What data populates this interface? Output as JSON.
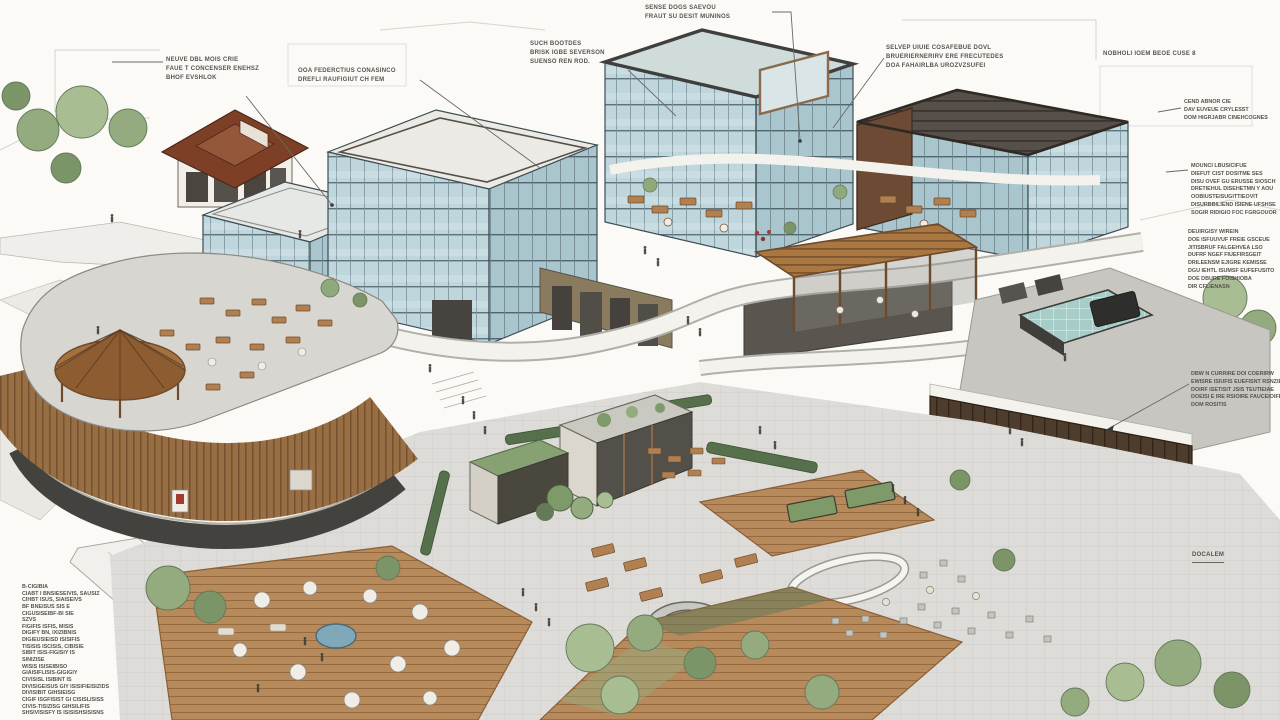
{
  "figure_title": "",
  "palette": {
    "background": "#fbfaf7",
    "glass_blue": "#bfd6dc",
    "glass_dark": "#a9c6ce",
    "mullion": "#5d727b",
    "wood_slat": "#a2764a",
    "wood_dark": "#7c5631",
    "pergola_wood": "#ab7741",
    "deck_wood": "#b78a5c",
    "paving_gray": "#dddcd8",
    "deck_gray": "#c7c6c1",
    "skylight_teal": "#a6cdc8",
    "dark_cladding": "#4e3c2c",
    "roof_red_brown": "#7d4026",
    "foliage": "#93ab7e",
    "foliage_dark": "#647a58",
    "slab_white": "#f4f2ec",
    "annotation_ink": "#55544f",
    "accent_red": "#a23c2e",
    "water_blue": "#7fa8b8"
  },
  "annotations": {
    "top_center": {
      "lines": [
        "SENSE DOGS SAEVOU",
        "FRAUT SU DESIT MUNINOS"
      ]
    },
    "top_left": {
      "lines": [
        "NEUVE DBL MOIS CRIE",
        "FAUE T CONCENSER ENEHSZ",
        "BHOF EVSHLOK"
      ]
    },
    "podium_note": {
      "lines": [
        "OOA FEDERCTIUS CONASINCO",
        "DREFLI RAUFIGIUT CH FEM"
      ]
    },
    "tower_mid": {
      "lines": [
        "SUCH BOOTDES",
        "BRISK IGBE SEVERSON",
        "SUENSO REN ROD."
      ]
    },
    "tower_right": {
      "lines": [
        "SELVEP UIUIE COSAFEBUE DOVL",
        "BRUERIERNERIRV ERE FRECUTEDES",
        "DOA FAHAIRLBA UROZVZSUFEI"
      ]
    },
    "site_right": {
      "lines": [
        "NOBHOLI IOEM BEOE CUSE 8"
      ]
    },
    "right_block_a": {
      "lines": [
        "CEND ABNOR CIE",
        "DAV EUVEUE CRYLESST",
        "DOM HIGRJABR CINEHCOGNES"
      ]
    },
    "right_block_b": {
      "lines": [
        "MOUNCI LBUSICIFUE",
        "DIEFUT CIST DOSITME SES",
        "DISU OVEF GU ERUSSE SIOSCH",
        "DRETIEHUL DISEHETMN Y AOU",
        "OOBIUSTEISUGITTIEOVIT",
        "DISURBBILIEND ISIENE UFSHSE",
        "SOGIR RIDIGIO FOC FGRGOUOR"
      ]
    },
    "right_block_c": {
      "lines": [
        "DEUIRGISY WIREIN",
        "DOE ISFUUVUF FREIE GSCEUE",
        "JITISBRUF FALGEHVEA LSO",
        "DUFRF NGEF FIUEFIRSGEIT",
        "DRILEENSM EJIGRE KEMISSE",
        "DGU IEHTL ISUMSF EUFEFUSITO",
        "DOE DBURE FOISHIOBA",
        "DIR CFLIENASN"
      ]
    },
    "loading_dock": {
      "lines": [
        "DBW N CURRIRE DOI COERIRW",
        "EWISRE ISIUFIS EUEFISNT RSNZIE",
        "DOIRF ISETISIT JSIS TEUTIEIAE",
        "DOEISI E IRE RSIOIRE FAUCEIOIFE",
        "DOM ROSITIS"
      ]
    },
    "scale_note": {
      "lines": [
        "DOCALEM"
      ]
    },
    "legend": {
      "lines": [
        "B-CIGIBIA",
        "CIABT I BNSIESEIVIS, SAUSIZ",
        "CIHBT ISUS, SIAISEIVS",
        "BF BNEISUS  SIS E",
        "CIGUSISEIBF-BI SIE",
        "SZVS",
        "FIGIFIS ISFIS, MISIS",
        "DIGIFY BN, IXIZIBNIS",
        "DIGIEUSIEISD ISISIFIS",
        "TISISIS ISCISIS, CIBISIE",
        "SIBIT ISIS-FIGISIY IS",
        "SINIZISE",
        "WISIS ISISEIBISO",
        "GIAISIFLISIS-GIGIGIY",
        "CIVISISL ISIBINT IS",
        "DIVISIGEISUS GIY ISISIFIEISIZIDS",
        "DIVISIBIT GIHSIEISG",
        "CIGIF ISGFISIST GI CISISLISISS",
        "CIVIS-TISIZISG GIHSILIFIS",
        "SHSIVISISFY IS ISISISHSISISNS"
      ]
    }
  }
}
